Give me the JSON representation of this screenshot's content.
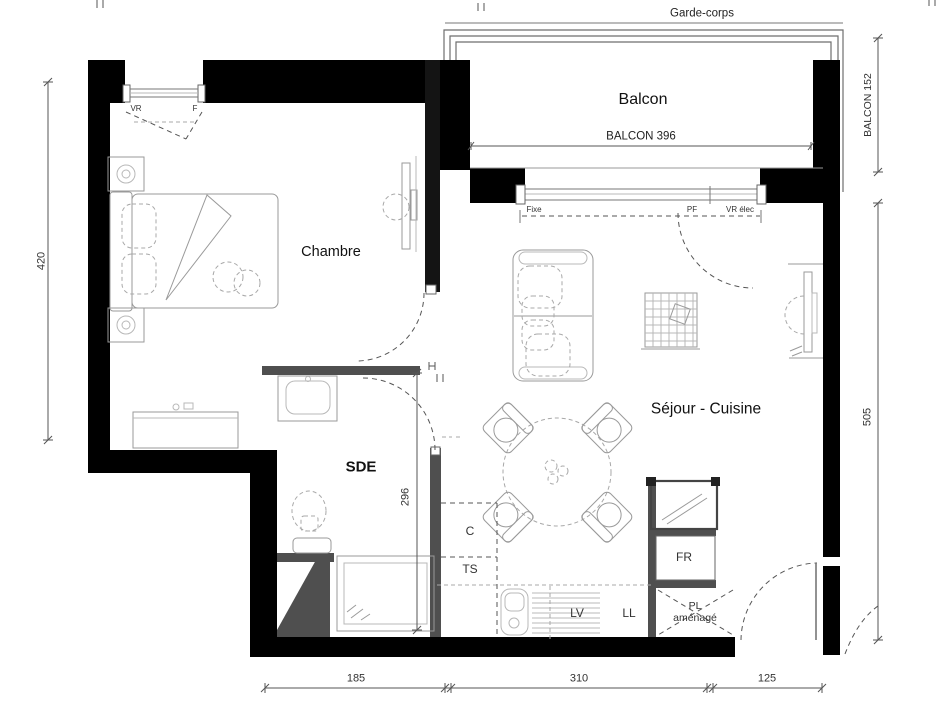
{
  "drawing": {
    "labels": {
      "garde_corps": "Garde-corps",
      "balcon": "Balcon",
      "balcon_width": "BALCON 396",
      "window_fixe": "Fixe",
      "window_pf": "PF",
      "window_vr_elec": "VR élec",
      "window_vr": "VR",
      "window_f": "F",
      "chambre": "Chambre",
      "sejour_cuisine": "Séjour - Cuisine",
      "sde": "SDE",
      "closet_c": "C",
      "closet_ts": "TS",
      "lv": "LV",
      "ll": "LL",
      "fr": "FR",
      "pl_line1": "PL",
      "pl_line2": "aménagé"
    },
    "dimensions": {
      "left_height": "420",
      "right_height": "505",
      "balcon_depth": "BALCON 152",
      "sde_height": "296",
      "bottom_left": "185",
      "bottom_center": "310",
      "bottom_right": "125"
    }
  }
}
